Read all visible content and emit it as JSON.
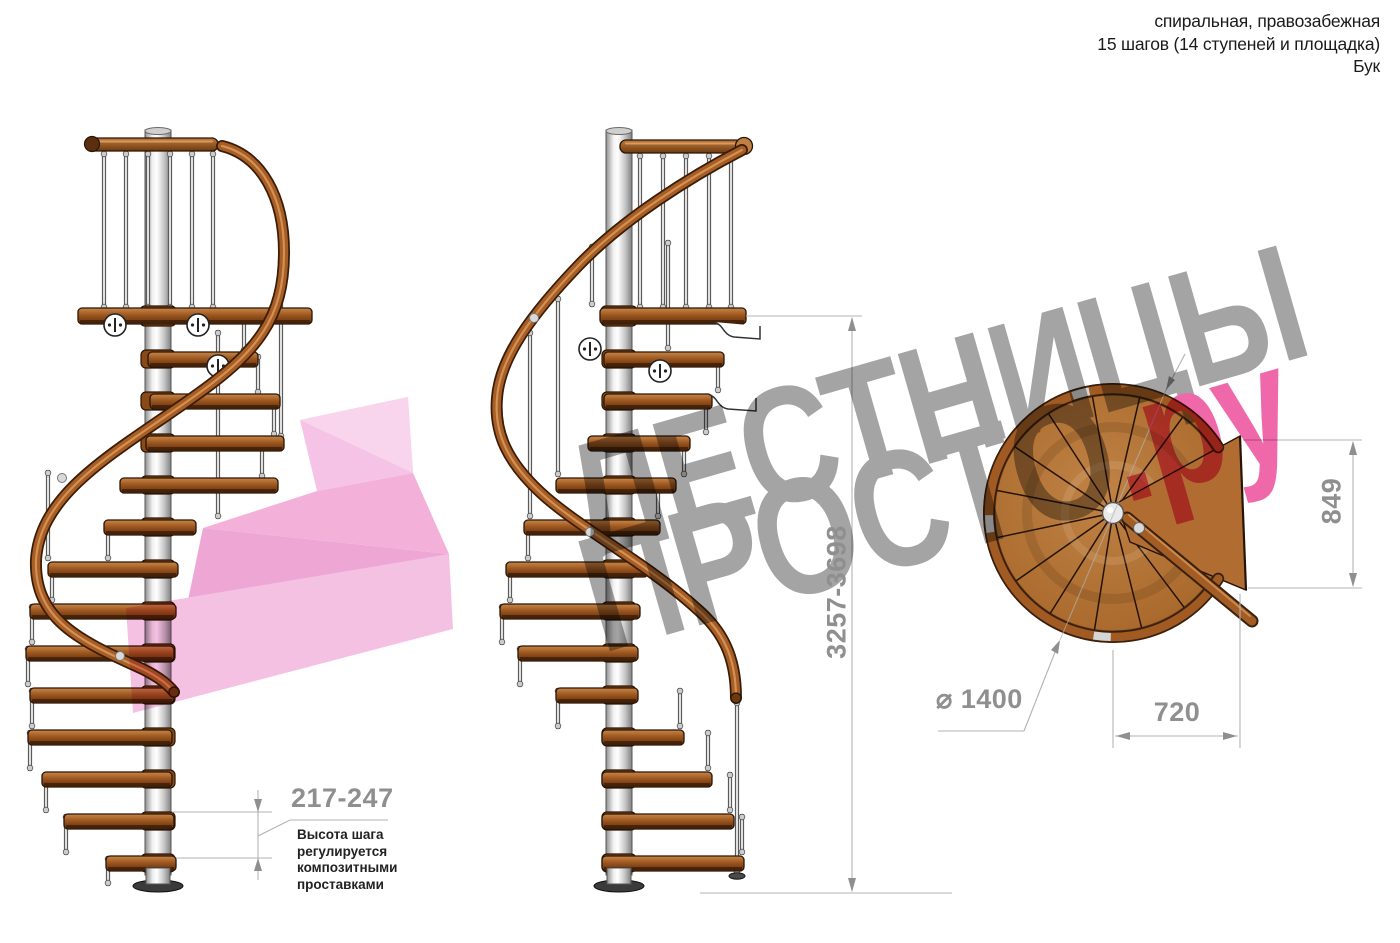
{
  "header": {
    "lines": [
      "спиральная, правозабежная",
      "15 шагов (14 ступеней и площадка)",
      "Бук"
    ]
  },
  "watermark": {
    "word1": "ЛЕСТНИЦЫ",
    "word2": "ПРОСТО",
    "suffix": ".ру"
  },
  "dimensions": {
    "step_height_range": "217-247",
    "total_height_range": "3257-3698",
    "landing_height": "849",
    "landing_width": "720",
    "diameter": "⌀ 1400"
  },
  "note": {
    "lines": [
      "Высота шага",
      "регулируется",
      "композитными",
      "проставками"
    ]
  },
  "colors": {
    "wood_step": "#a2601f",
    "wood_rail": "#a25c24",
    "wood_dark_edge": "#2a1505",
    "pole_silver": "#d9d9d9",
    "watermark_gray": "#9d9d9d",
    "watermark_pink": "#ee5ca4",
    "pink_arrow": "#f2abd8",
    "dimension_gray": "#8f8f8f"
  }
}
